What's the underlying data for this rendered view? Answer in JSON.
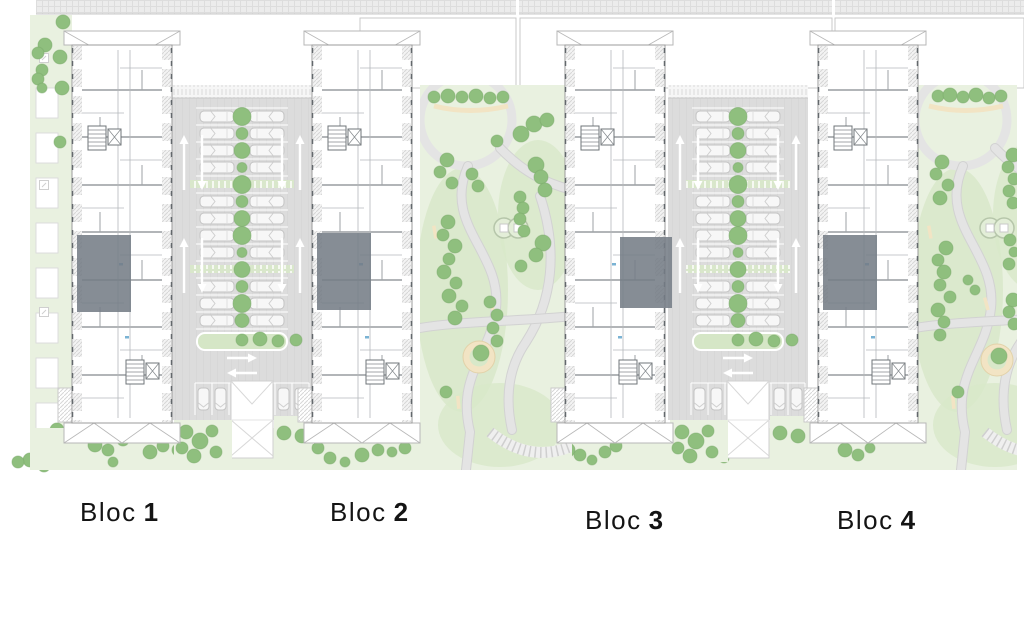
{
  "labels": {
    "blocks": [
      {
        "word": "Bloc",
        "num": "1"
      },
      {
        "word": "Bloc",
        "num": "2"
      },
      {
        "word": "Bloc",
        "num": "3"
      },
      {
        "word": "Bloc",
        "num": "4"
      }
    ]
  },
  "scene": {
    "colors": {
      "tree": "#8fbf7e",
      "tree_edge": "#79a96a",
      "grass": "#e9f1e0",
      "grass_dark": "#d8e8c9",
      "paving": "#dcdcdc",
      "paving_light": "#ececec",
      "path": "#e4e4e4",
      "path_edge": "#d2d2d2",
      "wall": "#6f7478",
      "wall_mid": "#84898d",
      "wall_light": "#b4b8bb",
      "highlight": "#747c85",
      "sand": "#f2e4c4",
      "sand_edge": "#e2d2a9",
      "line": "#c9c9c9",
      "roof": "#b7b7b7",
      "blue": "#7ab3d4",
      "label": "#141414",
      "white": "#ffffff"
    },
    "top_band": {
      "h": 14,
      "segments": [
        [
          36,
          516
        ],
        [
          519,
          832
        ],
        [
          835,
          1024
        ]
      ]
    },
    "plot_outlines": [
      [
        360,
        18,
        156,
        70
      ],
      [
        520,
        18,
        312,
        70
      ],
      [
        835,
        18,
        189,
        70
      ]
    ],
    "left_strip": {
      "x": 30,
      "y": 15,
      "w": 42,
      "h": 453,
      "balcony_ys": [
        88,
        133,
        178,
        223,
        268,
        313,
        358,
        403
      ],
      "posts": [
        [
          44,
          58
        ],
        [
          44,
          185
        ],
        [
          44,
          312
        ]
      ],
      "trees": [
        [
          63,
          22,
          7
        ],
        [
          45,
          45,
          7
        ],
        [
          38,
          53,
          6
        ],
        [
          60,
          57,
          7
        ],
        [
          42,
          70,
          6
        ],
        [
          38,
          79,
          6
        ],
        [
          62,
          88,
          7
        ],
        [
          42,
          88,
          5
        ],
        [
          60,
          142,
          6
        ],
        [
          57,
          430,
          7
        ],
        [
          68,
          442,
          6
        ],
        [
          30,
          460,
          7
        ],
        [
          18,
          462,
          6
        ],
        [
          44,
          466,
          6
        ]
      ]
    },
    "bottom_strip": {
      "x": 30,
      "y": 428,
      "w": 987,
      "h": 42,
      "trees": [
        [
          95,
          445,
          7
        ],
        [
          108,
          450,
          6
        ],
        [
          113,
          462,
          5
        ],
        [
          123,
          440,
          6
        ],
        [
          150,
          452,
          7
        ],
        [
          163,
          446,
          6
        ],
        [
          178,
          450,
          6
        ],
        [
          192,
          456,
          5
        ],
        [
          318,
          448,
          6
        ],
        [
          330,
          458,
          6
        ],
        [
          345,
          462,
          5
        ],
        [
          362,
          455,
          7
        ],
        [
          378,
          450,
          6
        ],
        [
          392,
          452,
          5
        ],
        [
          405,
          448,
          6
        ],
        [
          432,
          440,
          6
        ],
        [
          445,
          447,
          6
        ],
        [
          460,
          452,
          5
        ],
        [
          568,
          450,
          7
        ],
        [
          580,
          455,
          6
        ],
        [
          592,
          460,
          5
        ],
        [
          605,
          452,
          6
        ],
        [
          616,
          446,
          6
        ],
        [
          700,
          445,
          7
        ],
        [
          712,
          452,
          6
        ],
        [
          724,
          458,
          5
        ],
        [
          735,
          450,
          6
        ],
        [
          845,
          450,
          7
        ],
        [
          858,
          455,
          6
        ],
        [
          870,
          448,
          5
        ],
        [
          930,
          452,
          6
        ],
        [
          943,
          458,
          5
        ],
        [
          955,
          450,
          6
        ],
        [
          1000,
          452,
          6
        ],
        [
          1010,
          458,
          5
        ]
      ]
    },
    "block_dims": {
      "w": 100,
      "body_y": 45,
      "body_h": 378
    },
    "blocks": [
      {
        "x": 72,
        "highlight": {
          "side": "left",
          "y": 235,
          "h": 77
        }
      },
      {
        "x": 312,
        "highlight": {
          "side": "left",
          "y": 233,
          "h": 77
        }
      },
      {
        "x": 565,
        "highlight": {
          "side": "right",
          "y": 237,
          "h": 71
        }
      },
      {
        "x": 818,
        "highlight": {
          "side": "left",
          "y": 235,
          "h": 75
        }
      }
    ],
    "strip_dims": {
      "w": 140,
      "y": 85,
      "h": 335,
      "rows": 13,
      "row0": 108,
      "pitch": 17,
      "paver_rows": [
        4,
        9
      ],
      "tree_radii": [
        9,
        6,
        8,
        5,
        9,
        6,
        8,
        9,
        5,
        8,
        6,
        9,
        7
      ],
      "island_trees_rel": [
        [
          42,
          340,
          6
        ],
        [
          60,
          339,
          7
        ],
        [
          78,
          341,
          6
        ],
        [
          96,
          340,
          6
        ]
      ],
      "bottom_trees_rel": [
        [
          14,
          432,
          7
        ],
        [
          28,
          441,
          8
        ],
        [
          10,
          448,
          6
        ],
        [
          40,
          431,
          6
        ],
        [
          22,
          456,
          7
        ],
        [
          44,
          452,
          6
        ],
        [
          112,
          433,
          7
        ],
        [
          130,
          436,
          7
        ]
      ]
    },
    "parking_strips": [
      {
        "x": 172
      },
      {
        "x": 668
      }
    ],
    "parks": [
      {
        "x": 420,
        "w": 152,
        "sandbox": [
          479,
          357
        ],
        "playground": [
          504,
          228
        ],
        "trees": [
          [
            434,
            97,
            6
          ],
          [
            448,
            96,
            7
          ],
          [
            462,
            97,
            6
          ],
          [
            476,
            96,
            7
          ],
          [
            490,
            98,
            6
          ],
          [
            503,
            97,
            6
          ],
          [
            447,
            160,
            7
          ],
          [
            440,
            172,
            6
          ],
          [
            452,
            183,
            6
          ],
          [
            472,
            174,
            6
          ],
          [
            478,
            186,
            6
          ],
          [
            448,
            222,
            7
          ],
          [
            443,
            235,
            6
          ],
          [
            455,
            246,
            7
          ],
          [
            449,
            259,
            6
          ],
          [
            444,
            272,
            7
          ],
          [
            456,
            283,
            6
          ],
          [
            449,
            296,
            7
          ],
          [
            462,
            306,
            6
          ],
          [
            455,
            318,
            7
          ],
          [
            490,
            302,
            6
          ],
          [
            497,
            315,
            6
          ],
          [
            493,
            328,
            6
          ],
          [
            497,
            341,
            6
          ],
          [
            521,
            134,
            8
          ],
          [
            534,
            124,
            8
          ],
          [
            547,
            120,
            7
          ],
          [
            497,
            141,
            6
          ],
          [
            536,
            165,
            8
          ],
          [
            541,
            177,
            7
          ],
          [
            545,
            190,
            7
          ],
          [
            520,
            197,
            6
          ],
          [
            523,
            208,
            6
          ],
          [
            520,
            219,
            6
          ],
          [
            524,
            231,
            6
          ],
          [
            543,
            243,
            8
          ],
          [
            536,
            255,
            7
          ],
          [
            521,
            266,
            6
          ],
          [
            446,
            392,
            6
          ]
        ]
      },
      {
        "x": 915,
        "w": 102,
        "sandbox": [
          997,
          360
        ],
        "playground": [
          990,
          228
        ],
        "trees": [
          [
            938,
            96,
            6
          ],
          [
            950,
            95,
            7
          ],
          [
            963,
            97,
            6
          ],
          [
            976,
            95,
            7
          ],
          [
            989,
            98,
            6
          ],
          [
            1001,
            96,
            6
          ],
          [
            942,
            162,
            7
          ],
          [
            936,
            174,
            6
          ],
          [
            948,
            185,
            6
          ],
          [
            940,
            198,
            7
          ],
          [
            946,
            248,
            7
          ],
          [
            938,
            260,
            6
          ],
          [
            944,
            272,
            7
          ],
          [
            940,
            285,
            6
          ],
          [
            950,
            297,
            6
          ],
          [
            938,
            310,
            7
          ],
          [
            944,
            322,
            6
          ],
          [
            940,
            335,
            6
          ],
          [
            1013,
            155,
            7
          ],
          [
            1008,
            167,
            6
          ],
          [
            1014,
            179,
            6
          ],
          [
            1009,
            191,
            6
          ],
          [
            1013,
            203,
            6
          ],
          [
            1010,
            240,
            6
          ],
          [
            1014,
            252,
            5
          ],
          [
            1009,
            264,
            6
          ],
          [
            968,
            280,
            5
          ],
          [
            975,
            290,
            5
          ],
          [
            1013,
            300,
            7
          ],
          [
            1009,
            312,
            6
          ],
          [
            1014,
            324,
            6
          ],
          [
            958,
            392,
            6
          ]
        ]
      }
    ]
  }
}
